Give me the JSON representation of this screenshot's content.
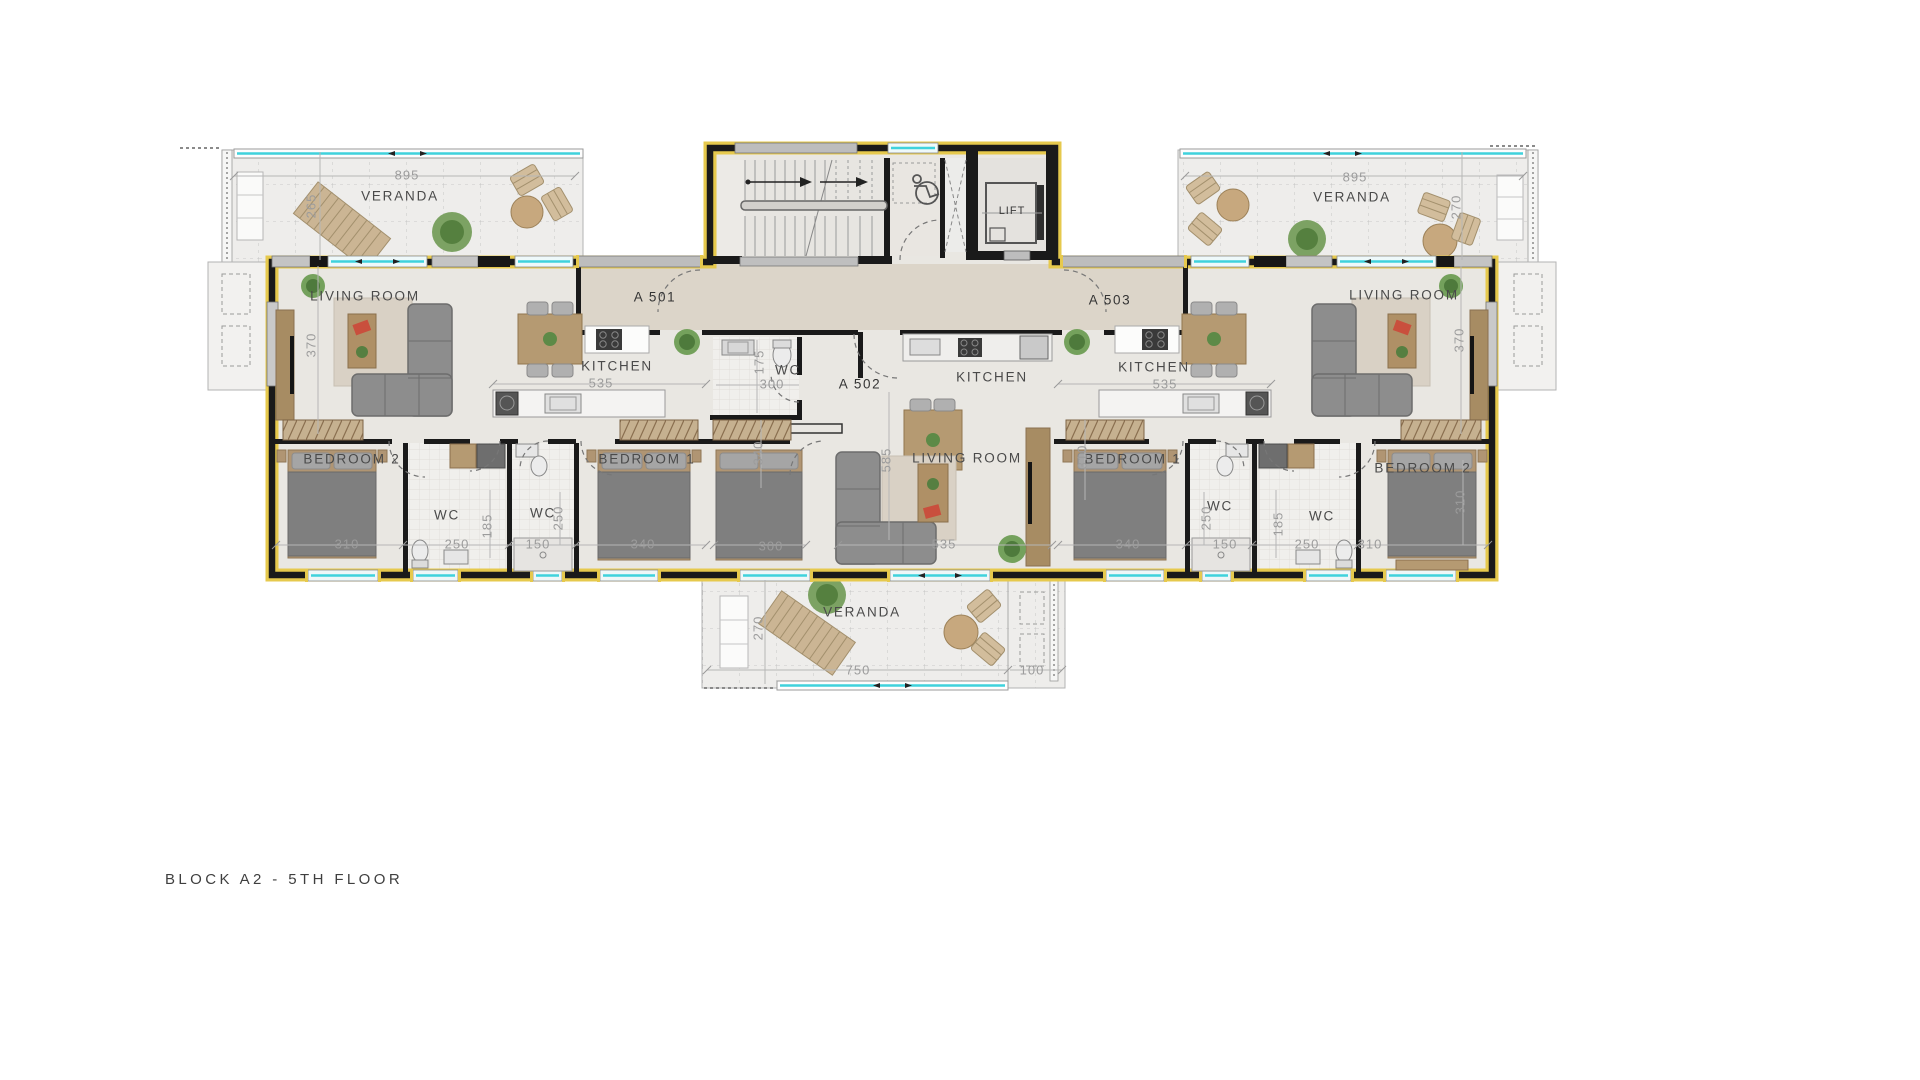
{
  "title": "BLOCK A2 - 5TH FLOOR",
  "labels": [
    {
      "name": "veranda-tl-dim-895",
      "text": "895",
      "x": 407,
      "y": 175,
      "cls": "dim"
    },
    {
      "name": "veranda-tl-label",
      "text": "VERANDA",
      "x": 400,
      "y": 196,
      "cls": "room"
    },
    {
      "name": "veranda-tl-dim-265",
      "text": "265",
      "x": 311,
      "y": 206,
      "cls": "dim",
      "rot": 1
    },
    {
      "name": "living-room-a501-label",
      "text": "LIVING ROOM",
      "x": 365,
      "y": 296,
      "cls": "room"
    },
    {
      "name": "dim-370-left",
      "text": "370",
      "x": 311,
      "y": 345,
      "cls": "dim",
      "rot": 1
    },
    {
      "name": "unit-a501-label",
      "text": "A 501",
      "x": 655,
      "y": 297,
      "cls": "unit"
    },
    {
      "name": "kitchen-a501-label",
      "text": "KITCHEN",
      "x": 617,
      "y": 366,
      "cls": "room"
    },
    {
      "name": "kitchen-a501-dim-535",
      "text": "535",
      "x": 601,
      "y": 383,
      "cls": "dim"
    },
    {
      "name": "bedroom2-a501-label",
      "text": "BEDROOM 2",
      "x": 352,
      "y": 459,
      "cls": "room"
    },
    {
      "name": "bedroom2-a501-dim-310",
      "text": "310",
      "x": 347,
      "y": 544,
      "cls": "dim"
    },
    {
      "name": "wc1-a501-label",
      "text": "WC",
      "x": 447,
      "y": 515,
      "cls": "room"
    },
    {
      "name": "wc1-a501-dim-250",
      "text": "250",
      "x": 457,
      "y": 544,
      "cls": "dim"
    },
    {
      "name": "dim-185-left",
      "text": "185",
      "x": 487,
      "y": 526,
      "cls": "dim",
      "rot": 1
    },
    {
      "name": "wc2-a501-label",
      "text": "WC",
      "x": 543,
      "y": 513,
      "cls": "room"
    },
    {
      "name": "wc2-a501-dim-150",
      "text": "150",
      "x": 538,
      "y": 544,
      "cls": "dim"
    },
    {
      "name": "wc2-a501-dim-250v",
      "text": "250",
      "x": 558,
      "y": 518,
      "cls": "dim",
      "rot": 1
    },
    {
      "name": "bedroom1-a501-label",
      "text": "BEDROOM 1",
      "x": 647,
      "y": 459,
      "cls": "room"
    },
    {
      "name": "bedroom1-a501-dim-340",
      "text": "340",
      "x": 643,
      "y": 544,
      "cls": "dim"
    },
    {
      "name": "wc-a502-label",
      "text": "WC",
      "x": 788,
      "y": 370,
      "cls": "room"
    },
    {
      "name": "wc-a502-dim-175",
      "text": "175",
      "x": 759,
      "y": 362,
      "cls": "dim",
      "rot": 1
    },
    {
      "name": "wc-a502-dim-300",
      "text": "300",
      "x": 772,
      "y": 384,
      "cls": "dim"
    },
    {
      "name": "unit-a502-label",
      "text": "A 502",
      "x": 860,
      "y": 384,
      "cls": "unit"
    },
    {
      "name": "dim-340-center",
      "text": "340",
      "x": 758,
      "y": 453,
      "cls": "dim",
      "rot": 1
    },
    {
      "name": "bedroom-a502-dim-300",
      "text": "300",
      "x": 771,
      "y": 546,
      "cls": "dim"
    },
    {
      "name": "kitchen-a502-label",
      "text": "KITCHEN",
      "x": 992,
      "y": 377,
      "cls": "room"
    },
    {
      "name": "living-room-a502-label",
      "text": "LIVING ROOM",
      "x": 967,
      "y": 458,
      "cls": "room"
    },
    {
      "name": "dim-585-center",
      "text": "585",
      "x": 886,
      "y": 460,
      "cls": "dim",
      "rot": 1
    },
    {
      "name": "living-room-a502-dim-535",
      "text": "535",
      "x": 944,
      "y": 544,
      "cls": "dim"
    },
    {
      "name": "unit-a503-label",
      "text": "A 503",
      "x": 1110,
      "y": 300,
      "cls": "unit"
    },
    {
      "name": "kitchen-a503-label",
      "text": "KITCHEN",
      "x": 1154,
      "y": 367,
      "cls": "room"
    },
    {
      "name": "kitchen-a503-dim-535",
      "text": "535",
      "x": 1165,
      "y": 384,
      "cls": "dim"
    },
    {
      "name": "living-room-a503-label",
      "text": "LIVING ROOM",
      "x": 1404,
      "y": 295,
      "cls": "room"
    },
    {
      "name": "dim-370-right",
      "text": "370",
      "x": 1459,
      "y": 340,
      "cls": "dim",
      "rot": 1
    },
    {
      "name": "bedroom1-a503-label",
      "text": "BEDROOM 1",
      "x": 1133,
      "y": 459,
      "cls": "room"
    },
    {
      "name": "dim-310-right1",
      "text": "310",
      "x": 1082,
      "y": 457,
      "cls": "dim",
      "rot": 1
    },
    {
      "name": "bedroom1-a503-dim-340",
      "text": "340",
      "x": 1128,
      "y": 544,
      "cls": "dim"
    },
    {
      "name": "wc1-a503-label",
      "text": "WC",
      "x": 1220,
      "y": 506,
      "cls": "room"
    },
    {
      "name": "wc1-a503-dim-250v",
      "text": "250",
      "x": 1206,
      "y": 518,
      "cls": "dim",
      "rot": 1
    },
    {
      "name": "wc1-a503-dim-150",
      "text": "150",
      "x": 1225,
      "y": 544,
      "cls": "dim"
    },
    {
      "name": "dim-185-right",
      "text": "185",
      "x": 1278,
      "y": 524,
      "cls": "dim",
      "rot": 1
    },
    {
      "name": "wc2-a503-label",
      "text": "WC",
      "x": 1322,
      "y": 516,
      "cls": "room"
    },
    {
      "name": "wc2-a503-dim-250",
      "text": "250",
      "x": 1307,
      "y": 544,
      "cls": "dim"
    },
    {
      "name": "bedroom2-a503-label",
      "text": "BEDROOM 2",
      "x": 1423,
      "y": 468,
      "cls": "room"
    },
    {
      "name": "bedroom2-a503-dim-310",
      "text": "310",
      "x": 1370,
      "y": 544,
      "cls": "dim"
    },
    {
      "name": "dim-310-right2",
      "text": "310",
      "x": 1460,
      "y": 502,
      "cls": "dim",
      "rot": 1
    },
    {
      "name": "veranda-tr-dim-895",
      "text": "895",
      "x": 1355,
      "y": 177,
      "cls": "dim"
    },
    {
      "name": "veranda-tr-label",
      "text": "VERANDA",
      "x": 1352,
      "y": 197,
      "cls": "room"
    },
    {
      "name": "veranda-tr-dim-270",
      "text": "270",
      "x": 1456,
      "y": 207,
      "cls": "dim",
      "rot": 1
    },
    {
      "name": "veranda-bottom-label",
      "text": "VERANDA",
      "x": 862,
      "y": 612,
      "cls": "room"
    },
    {
      "name": "veranda-bottom-dim-270",
      "text": "270",
      "x": 758,
      "y": 628,
      "cls": "dim",
      "rot": 1
    },
    {
      "name": "veranda-bottom-dim-750",
      "text": "750",
      "x": 858,
      "y": 670,
      "cls": "dim"
    },
    {
      "name": "veranda-bottom-dim-100",
      "text": "100",
      "x": 1032,
      "y": 670,
      "cls": "dim"
    },
    {
      "name": "lift-label",
      "text": "LIFT",
      "x": 1012,
      "y": 211,
      "cls": "small"
    }
  ]
}
